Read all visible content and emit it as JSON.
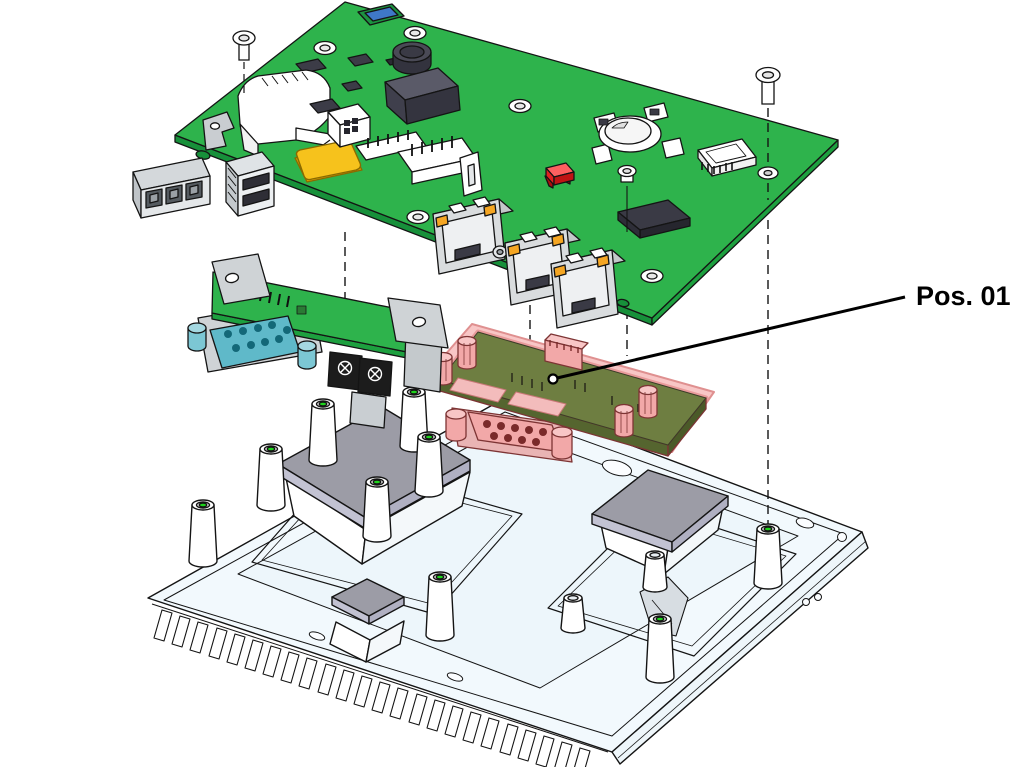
{
  "callout": {
    "label": "Pos. 01"
  },
  "colors": {
    "background": "#ffffff",
    "outline": "#141414",
    "pcb_green": "#2eb34c",
    "pcb_green_edge": "#17903a",
    "pcb_green_edge2": "#1da03f",
    "expansion_board_olive": "#6e7e41",
    "highlight_pink": "#f2a8a8",
    "highlight_pink_light": "#f8c6c6",
    "highlight_outline": "#7d3434",
    "teal_connector": "#5fb9c9",
    "teal_dark": "#19707f",
    "chassis_white": "#f2f9fd",
    "thermal_pad_gray": "#9c9ca6",
    "thermal_pad_side": "#c0c0d2",
    "led_orange": "#f5a623",
    "antenna_yellow": "#f6c21c",
    "status_red": "#e02020",
    "connector_blue": "#3f78c8",
    "standoff_hole_green": "#1ed41c",
    "metal_gray": "#cfd3d6",
    "chip_dark": "#3c3c47"
  }
}
